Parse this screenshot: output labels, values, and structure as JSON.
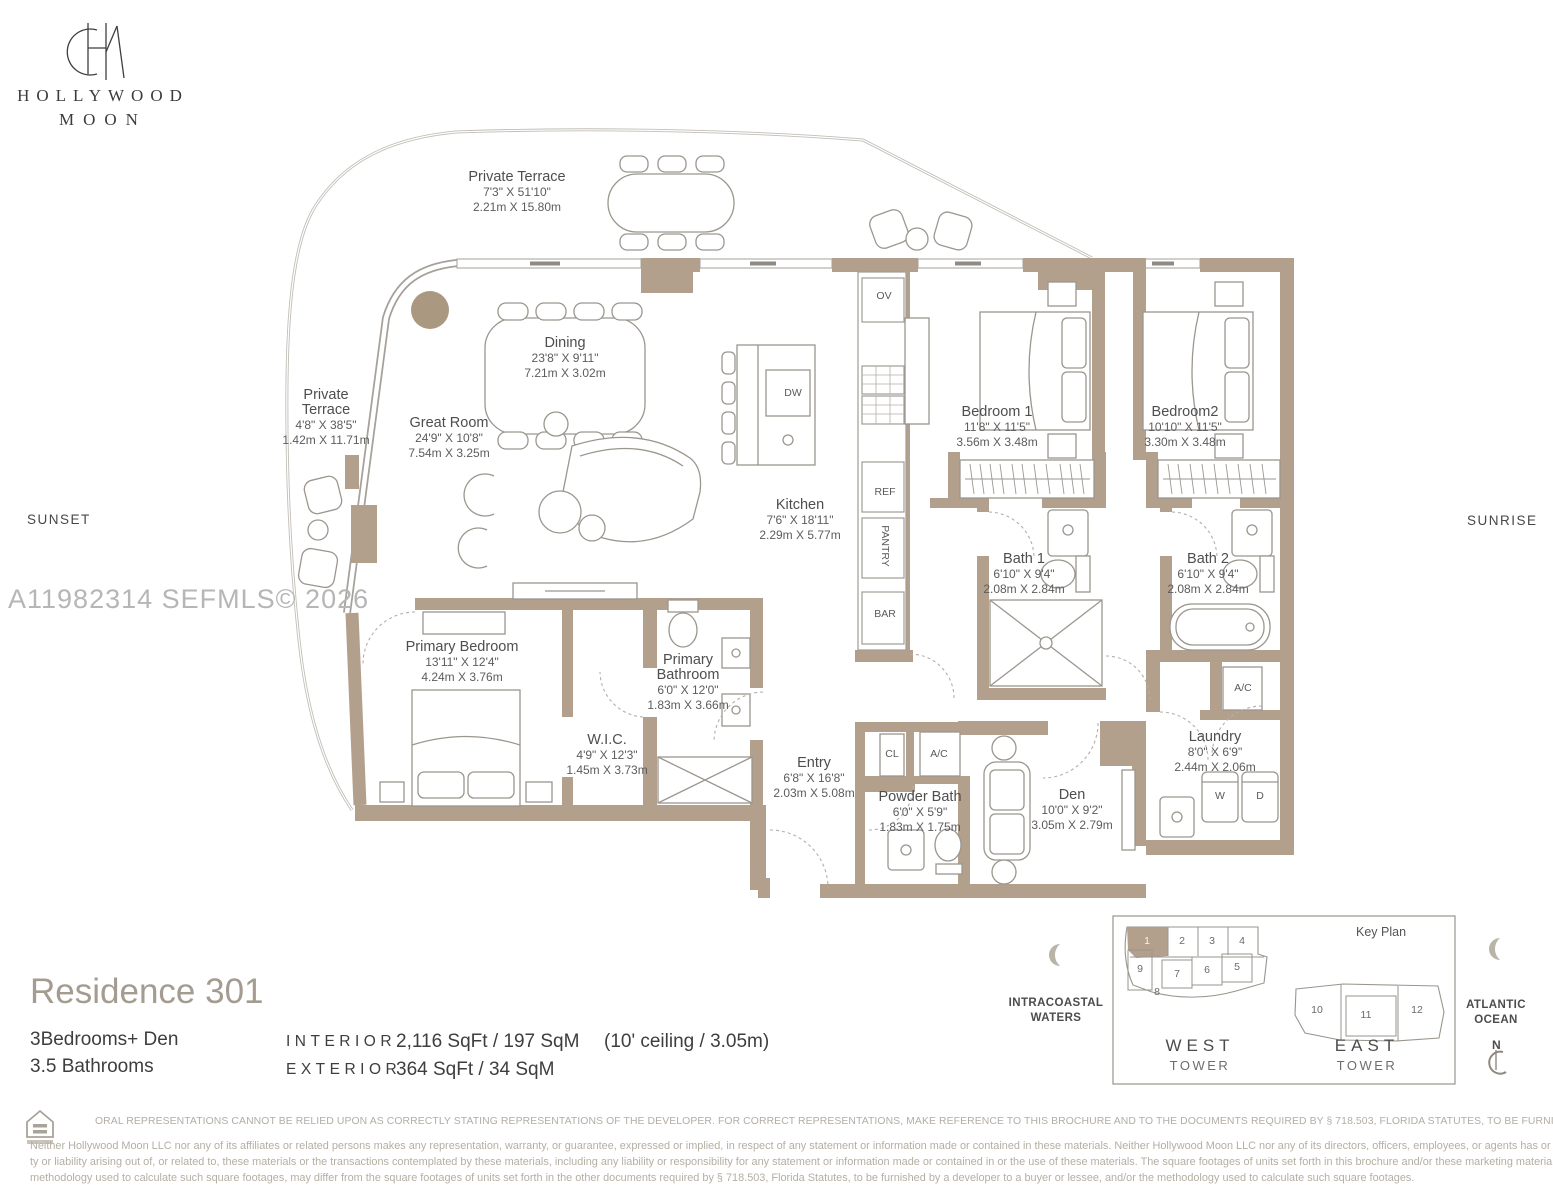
{
  "brand": {
    "line1": "HOLLYWOOD",
    "line2": "MOON"
  },
  "orientation": {
    "left": "SUNSET",
    "right": "SUNRISE"
  },
  "watermark": "A11982314  SEFMLS© 2026",
  "rooms": [
    {
      "name": "Private Terrace",
      "imperial": "7'3\" X 51'10\"",
      "metric": "2.21m X 15.80m"
    },
    {
      "name": "Private Terrace",
      "imperial": "4'8\" X 38'5\"",
      "metric": "1.42m X 11.71m"
    },
    {
      "name": "Dining",
      "imperial": "23'8\" X 9'11\"",
      "metric": "7.21m X 3.02m"
    },
    {
      "name": "Great Room",
      "imperial": "24'9\" X 10'8\"",
      "metric": "7.54m X 3.25m"
    },
    {
      "name": "Kitchen",
      "imperial": "7'6\" X 18'11\"",
      "metric": "2.29m X 5.77m"
    },
    {
      "name": "Bedroom 1",
      "imperial": "11'8\" X 11'5\"",
      "metric": "3.56m X 3.48m"
    },
    {
      "name": "Bedroom2",
      "imperial": "10'10\" X 11'5\"",
      "metric": "3.30m X 3.48m"
    },
    {
      "name": "Bath 1",
      "imperial": "6'10\" X 9'4\"",
      "metric": "2.08m X 2.84m"
    },
    {
      "name": "Bath 2",
      "imperial": "6'10\" X 9'4\"",
      "metric": "2.08m X 2.84m"
    },
    {
      "name": "Primary Bedroom",
      "imperial": "13'11\" X 12'4\"",
      "metric": "4.24m X 3.76m"
    },
    {
      "name": "Primary Bathroom",
      "imperial": "6'0\" X 12'0\"",
      "metric": "1.83m X 3.66m"
    },
    {
      "name": "W.I.C.",
      "imperial": "4'9\" X 12'3\"",
      "metric": "1.45m X 3.73m"
    },
    {
      "name": "Entry",
      "imperial": "6'8\" X 16'8\"",
      "metric": "2.03m X 5.08m"
    },
    {
      "name": "Powder Bath",
      "imperial": "6'0\" X 5'9\"",
      "metric": "1.83m X 1.75m"
    },
    {
      "name": "Den",
      "imperial": "10'0\" X 9'2\"",
      "metric": "3.05m X 2.79m"
    },
    {
      "name": "Laundry",
      "imperial": "8'0\" X 6'9\"",
      "metric": "2.44m X 2.06m"
    }
  ],
  "appliances": {
    "ov": "OV",
    "dw": "DW",
    "ref": "REF",
    "pantry": "PANTRY",
    "bar": "BAR",
    "cl": "CL",
    "ac1": "A/C",
    "ac2": "A/C",
    "washer": "W",
    "dryer": "D"
  },
  "residence": {
    "title": "Residence 301",
    "bedrooms": "3Bedrooms+ Den",
    "bathrooms": "3.5 Bathrooms",
    "interior_label": "INTERIOR",
    "interior_value": "2,116 SqFt / 197 SqM",
    "exterior_label": "EXTERIOR",
    "exterior_value": "364 SqFt / 34 SqM",
    "ceiling": "(10' ceiling / 3.05m)"
  },
  "key_plan": {
    "title": "Key Plan",
    "west_tower_line1": "WEST",
    "west_tower_line2": "TOWER",
    "east_tower_line1": "EAST",
    "east_tower_line2": "TOWER",
    "west_units": [
      "1",
      "2",
      "3",
      "4",
      "9",
      "7",
      "6",
      "5",
      "8"
    ],
    "east_units": [
      "10",
      "11",
      "12"
    ],
    "highlighted_unit": "1",
    "left_label_line1": "INTRACOASTAL",
    "left_label_line2": "WATERS",
    "right_label_line1": "ATLANTIC",
    "right_label_line2": "OCEAN",
    "north_label": "N"
  },
  "footer": {
    "line_caps": "ORAL REPRESENTATIONS CANNOT BE RELIED UPON AS CORRECTLY STATING REPRESENTATIONS OF THE DEVELOPER. FOR CORRECT REPRESENTATIONS, MAKE REFERENCE TO THIS BROCHURE AND TO THE DOCUMENTS REQUIRED BY § 718.503, FLORIDA STATUTES, TO BE FURNISHED BY A DEVELOPER TO A BUYER OR LESSEE",
    "para_line1": "Neither Hollywood Moon LLC nor any of its affiliates or related persons makes any representation, warranty, or guarantee, expressed or implied, in respect of any statement or information made or contained in these materials. Neither Hollywood Moon LLC nor any of its directors, officers, employees, or agents has or will have any responsibili",
    "para_line2": "ty or liability arising out of, or related to, these materials or the transactions contemplated by these materials, including any liability or responsibility for any statement or information made or contained in or the use of these materials. The square footages of units set forth in this brochure and/or these marketing materials, and/or the",
    "para_line3": "methodology used to calculate such square footages, may differ from the square footages of units set forth in the other documents required by § 718.503, Florida Statutes, to be furnished by a developer to a buyer or lessee, and/or the methodology used to calculate such square footages."
  },
  "colors": {
    "wall": "#b3a08c",
    "planter": "#ab9880",
    "line": "#9b968e",
    "boundary": "#c7c3bc",
    "accent_title": "#a49c90",
    "footer_text": "#b6aea2"
  }
}
